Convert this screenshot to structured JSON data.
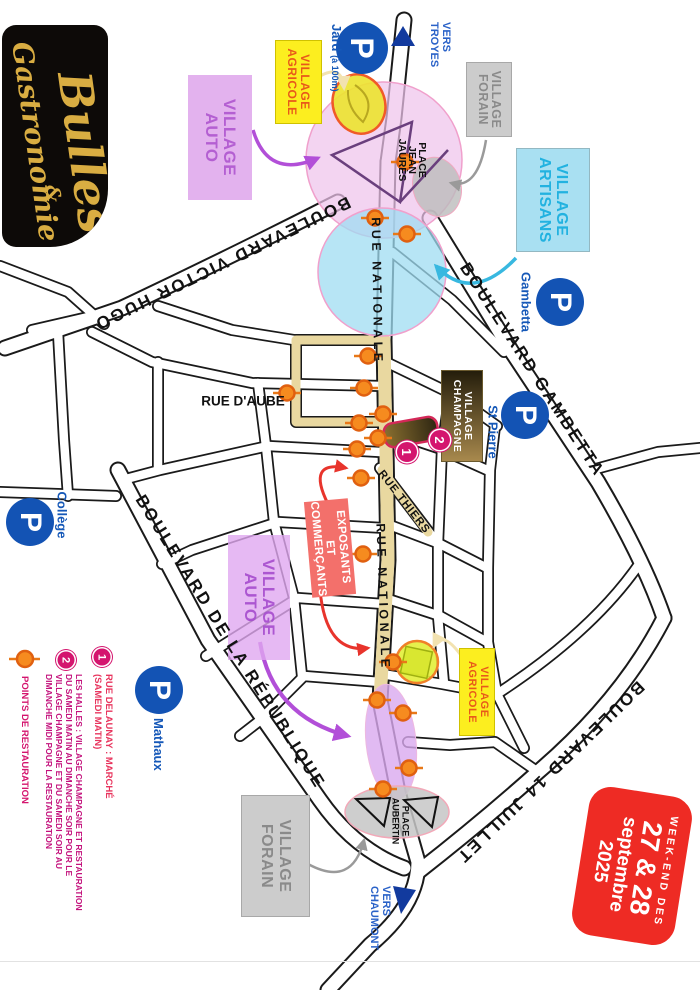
{
  "logo": {
    "word1": "Bulles",
    "amp": "&",
    "word2": "Gastronomie"
  },
  "date_badge": {
    "l1": "WEEK-END DES",
    "l2": "27 & 28",
    "l3": "septembre",
    "l4": "2025"
  },
  "villages": {
    "auto": {
      "w1": "VILLAGE",
      "w2": "AUTO"
    },
    "agricole": {
      "w1": "VILLAGE",
      "w2": "AGRICOLE"
    },
    "artisans": {
      "w1": "VILLAGE",
      "w2": "ARTISANS"
    },
    "forain": {
      "w1": "VILLAGE",
      "w2": "FORAIN"
    },
    "champagne": {
      "w1": "VILLAGE",
      "w2": "CHAMPAGNE"
    }
  },
  "exposants": {
    "l1": "EXPOSANTS",
    "l2": "ET COMMERÇANTS"
  },
  "boulevards": {
    "victor_hugo": "BOULEVARD VICTOR HUGO",
    "republique": "BOULEVARD DE LA RÉPUBLIQUE",
    "gambetta": "BOULEVARD GAMBETTA",
    "quatorze_juillet": "BOULEVARD 14 JUILLET"
  },
  "rues": {
    "nationale": "RUE NATIONALE",
    "thiers": "RUE THIERS",
    "aube": "RUE D'AUBE"
  },
  "places": {
    "jean_jaures": {
      "l1": "PLACE",
      "l2": "JEAN",
      "l3": "JAURÈS"
    },
    "aubertin": {
      "l1": "PLACE",
      "l2": "AUBERTIN"
    }
  },
  "parking": {
    "symbol": "P",
    "jard": {
      "name": "Jard",
      "note": "(à 100m)"
    },
    "gambetta": "Gambetta",
    "st_pierre": "St Pierre",
    "college": "Collège",
    "mathaux": "Mathaux"
  },
  "directions": {
    "troyes": {
      "l1": "VERS",
      "l2": "TROYES"
    },
    "chaumont": {
      "l1": "VERS",
      "l2": "CHAUMONT"
    }
  },
  "markers": {
    "one": "1",
    "two": "2"
  },
  "legend": {
    "item1": {
      "l1": "RUE DELAUNAY : MARCHÉ",
      "l2": "(SAMEDI MATIN)"
    },
    "item2": {
      "l1": "LES HALLES : VILLAGE CHAMPAGNE ET RESTAURATION",
      "l2": "DU SAMEDI MATIN AU DIMANCHE SOIR POUR LE",
      "l3": "VILLAGE CHAMPAGNE ET DU SAMEDI SOIR AU",
      "l4": "DIMANCHE MIDI POUR LA RESTAURATION"
    },
    "item3": {
      "label": "POINTS DE RESTAURATION"
    }
  },
  "restauration_points": [
    [
      162,
      295
    ],
    [
      218,
      325
    ],
    [
      234,
      293
    ],
    [
      356,
      332
    ],
    [
      388,
      336
    ],
    [
      414,
      317
    ],
    [
      423,
      341
    ],
    [
      438,
      322
    ],
    [
      449,
      343
    ],
    [
      478,
      339
    ],
    [
      393,
      413
    ],
    [
      554,
      337
    ],
    [
      662,
      307
    ],
    [
      700,
      323
    ],
    [
      713,
      297
    ],
    [
      768,
      291
    ],
    [
      789,
      317
    ]
  ],
  "colors": {
    "parking_blue": "#1353b4",
    "direction_blue": "#2a62c8",
    "village_auto": "#e3b2ee",
    "village_agricole": "#fcee1f",
    "village_artisans": "#a9e0f2",
    "village_forain": "#cccccc",
    "village_champagne_dark": "#241d0b",
    "exposants_red": "#f3706b",
    "date_badge_red": "#ee2b24",
    "marker_magenta": "#d4156e",
    "restauration_orange": "#f68b1f",
    "street_highlight_tan": "#e9d8a0",
    "zone_pink": "#eec3ec",
    "zone_cyan": "#9fdcf2",
    "zone_purple": "#d9a9ef",
    "logo_gold": "#d9ad42"
  }
}
